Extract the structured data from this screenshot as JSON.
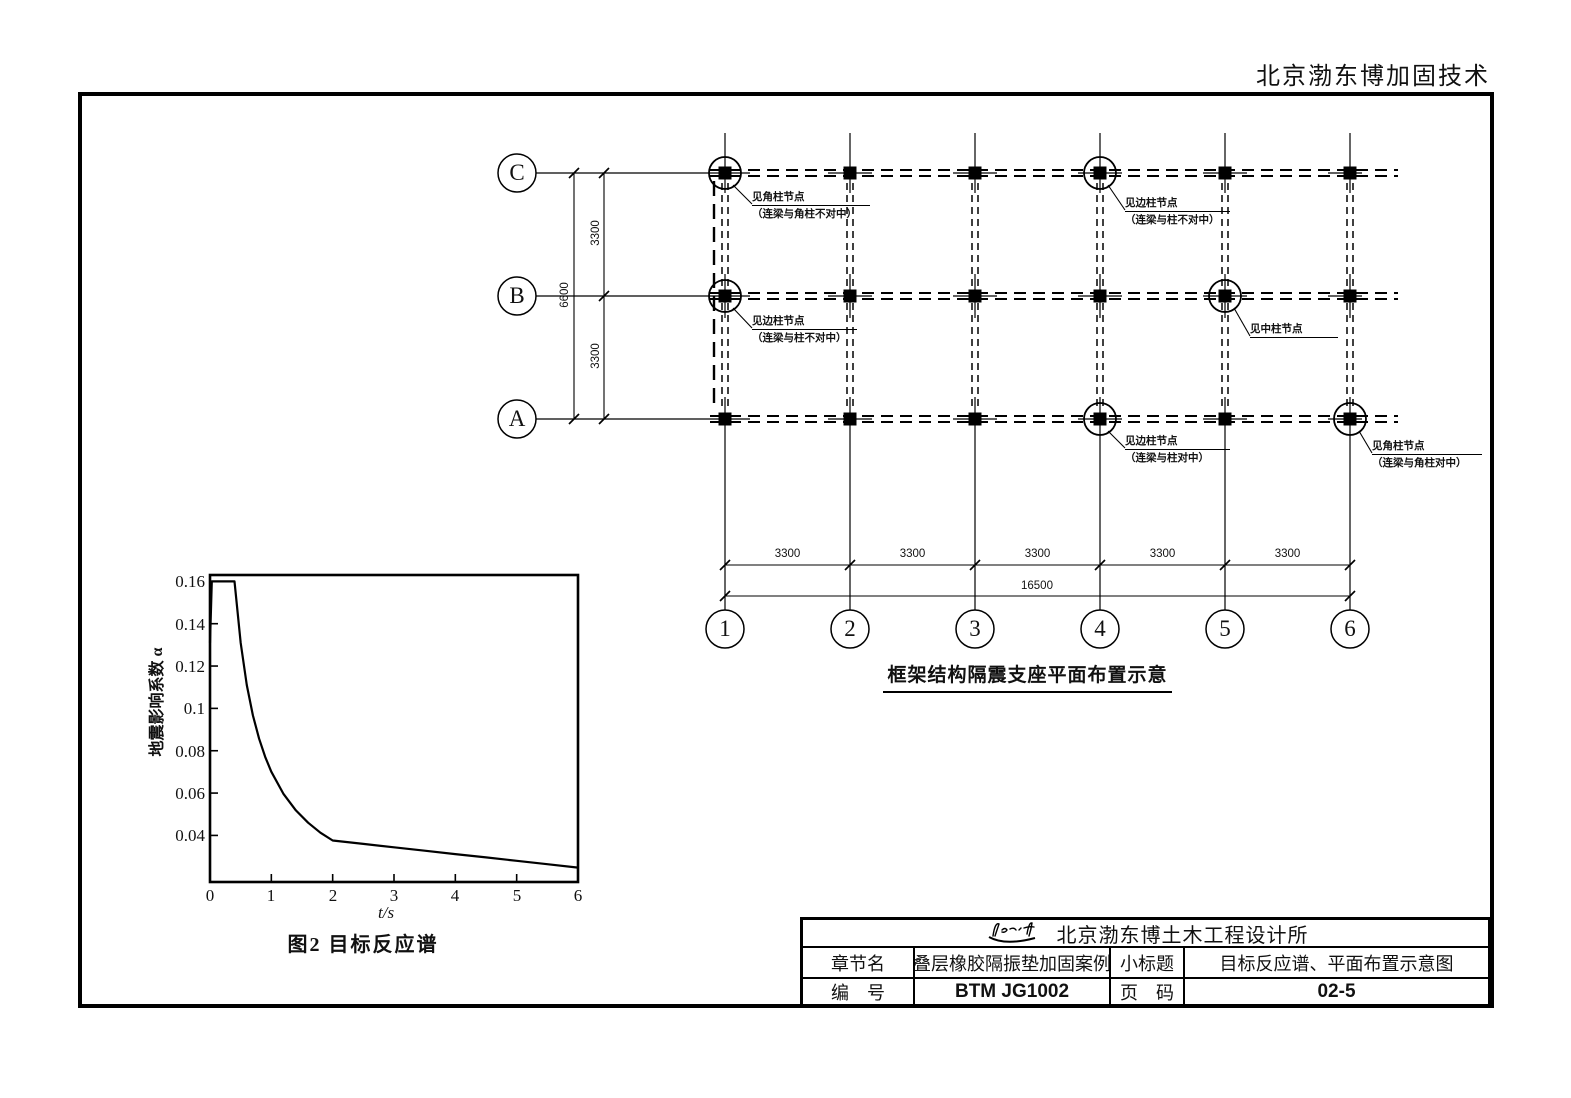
{
  "page": {
    "header": "北京渤东博加固技术"
  },
  "plan": {
    "title": "框架结构隔震支座平面布置示意",
    "row_labels": [
      "C",
      "B",
      "A"
    ],
    "col_labels": [
      "1",
      "2",
      "3",
      "4",
      "5",
      "6"
    ],
    "dims": {
      "h_spans": [
        "3300",
        "3300",
        "3300",
        "3300",
        "3300"
      ],
      "h_total": "16500",
      "v_spans": [
        "3300",
        "3300"
      ],
      "v_total": "6600"
    },
    "callouts": [
      {
        "id": "C1",
        "line1": "见角柱节点",
        "line2": "（连梁与角柱不对中）"
      },
      {
        "id": "C4",
        "line1": "见边柱节点",
        "line2": "（连梁与柱不对中）"
      },
      {
        "id": "B1",
        "line1": "见边柱节点",
        "line2": "（连梁与柱不对中）"
      },
      {
        "id": "B5",
        "line1": "见中柱节点",
        "line2": ""
      },
      {
        "id": "A4",
        "line1": "见边柱节点",
        "line2": "（连梁与柱对中）"
      },
      {
        "id": "A6",
        "line1": "见角柱节点",
        "line2": "（连梁与角柱对中）"
      }
    ]
  },
  "chart_data": {
    "type": "line",
    "title": "图2  目标反应谱",
    "xlabel": "t/s",
    "ylabel": "地震影响系数 α",
    "xticks": [
      "0",
      "1",
      "2",
      "3",
      "4",
      "5",
      "6"
    ],
    "yticks": [
      "0.16",
      "0.14",
      "0.12",
      "0.1",
      "0.08",
      "0.06",
      "0.04"
    ],
    "xlim": [
      0,
      6
    ],
    "ylim": [
      0.018,
      0.163
    ],
    "grid": false,
    "legend": "none",
    "points": [
      [
        0,
        0.131
      ],
      [
        0.03,
        0.16
      ],
      [
        0.4,
        0.16
      ],
      [
        0.5,
        0.1309
      ],
      [
        0.6,
        0.111
      ],
      [
        0.7,
        0.0967
      ],
      [
        0.8,
        0.0857
      ],
      [
        0.9,
        0.0771
      ],
      [
        1.0,
        0.0701
      ],
      [
        1.2,
        0.0595
      ],
      [
        1.4,
        0.0518
      ],
      [
        1.6,
        0.046
      ],
      [
        1.8,
        0.0413
      ],
      [
        2.0,
        0.0376
      ],
      [
        2.5,
        0.036
      ],
      [
        3.0,
        0.0344
      ],
      [
        3.5,
        0.0328
      ],
      [
        4.0,
        0.0312
      ],
      [
        4.5,
        0.0296
      ],
      [
        5.0,
        0.028
      ],
      [
        5.5,
        0.0264
      ],
      [
        6.0,
        0.0248
      ]
    ]
  },
  "titleblock": {
    "company": "北京渤东博土木工程设计所",
    "logo": "signature-logo",
    "row1": {
      "label1": "章节名",
      "value1": "叠层橡胶隔振垫加固案例",
      "label2": "小标题",
      "value2": "目标反应谱、平面布置示意图"
    },
    "row2": {
      "label1": "编　号",
      "value1": "BTM JG1002",
      "label2": "页　码",
      "value2": "02-5"
    }
  }
}
